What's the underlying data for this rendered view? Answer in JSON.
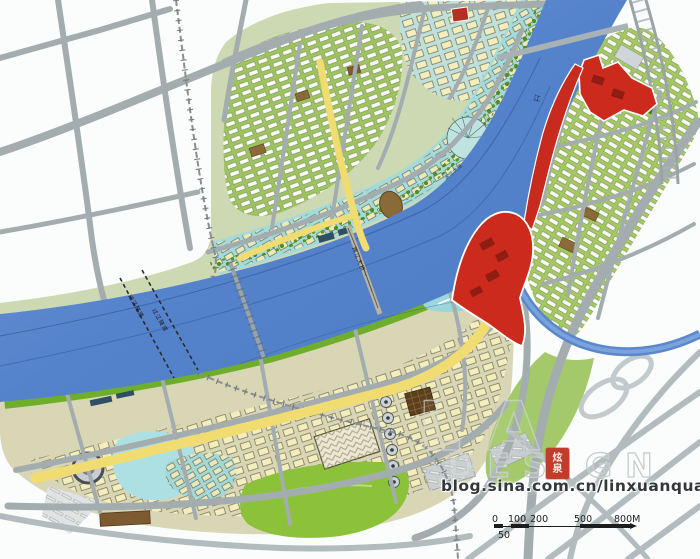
{
  "map": {
    "type": "urban waterfront master plan",
    "river_label": "江",
    "labels": {
      "tunnel_left": "过江隧道",
      "tunnel_right": "过江隧道",
      "bridge_main": "跨江大桥",
      "embankment": "滨江大道"
    }
  },
  "watermark": {
    "large_text": "LA",
    "design_text": "DESIGN",
    "seal_chars": [
      "炫",
      "泉"
    ],
    "blog_url": "blog.sina.com.cn/linxuanquan"
  },
  "scalebar": {
    "labels": [
      "0",
      "100",
      "200",
      "500",
      "800M"
    ],
    "minor_label": "50"
  },
  "palette": {
    "river": "#5b87cb",
    "road_gray": "#a3adaf",
    "park_green": "#8cc23a",
    "residential_green": "#a3c960",
    "commercial_teal": "#a6dad8",
    "building_cream": "#f4edbe",
    "landmark_red": "#cd2a1e",
    "main_road_yellow": "#f1dc72",
    "brown_building": "#8a6a38"
  }
}
